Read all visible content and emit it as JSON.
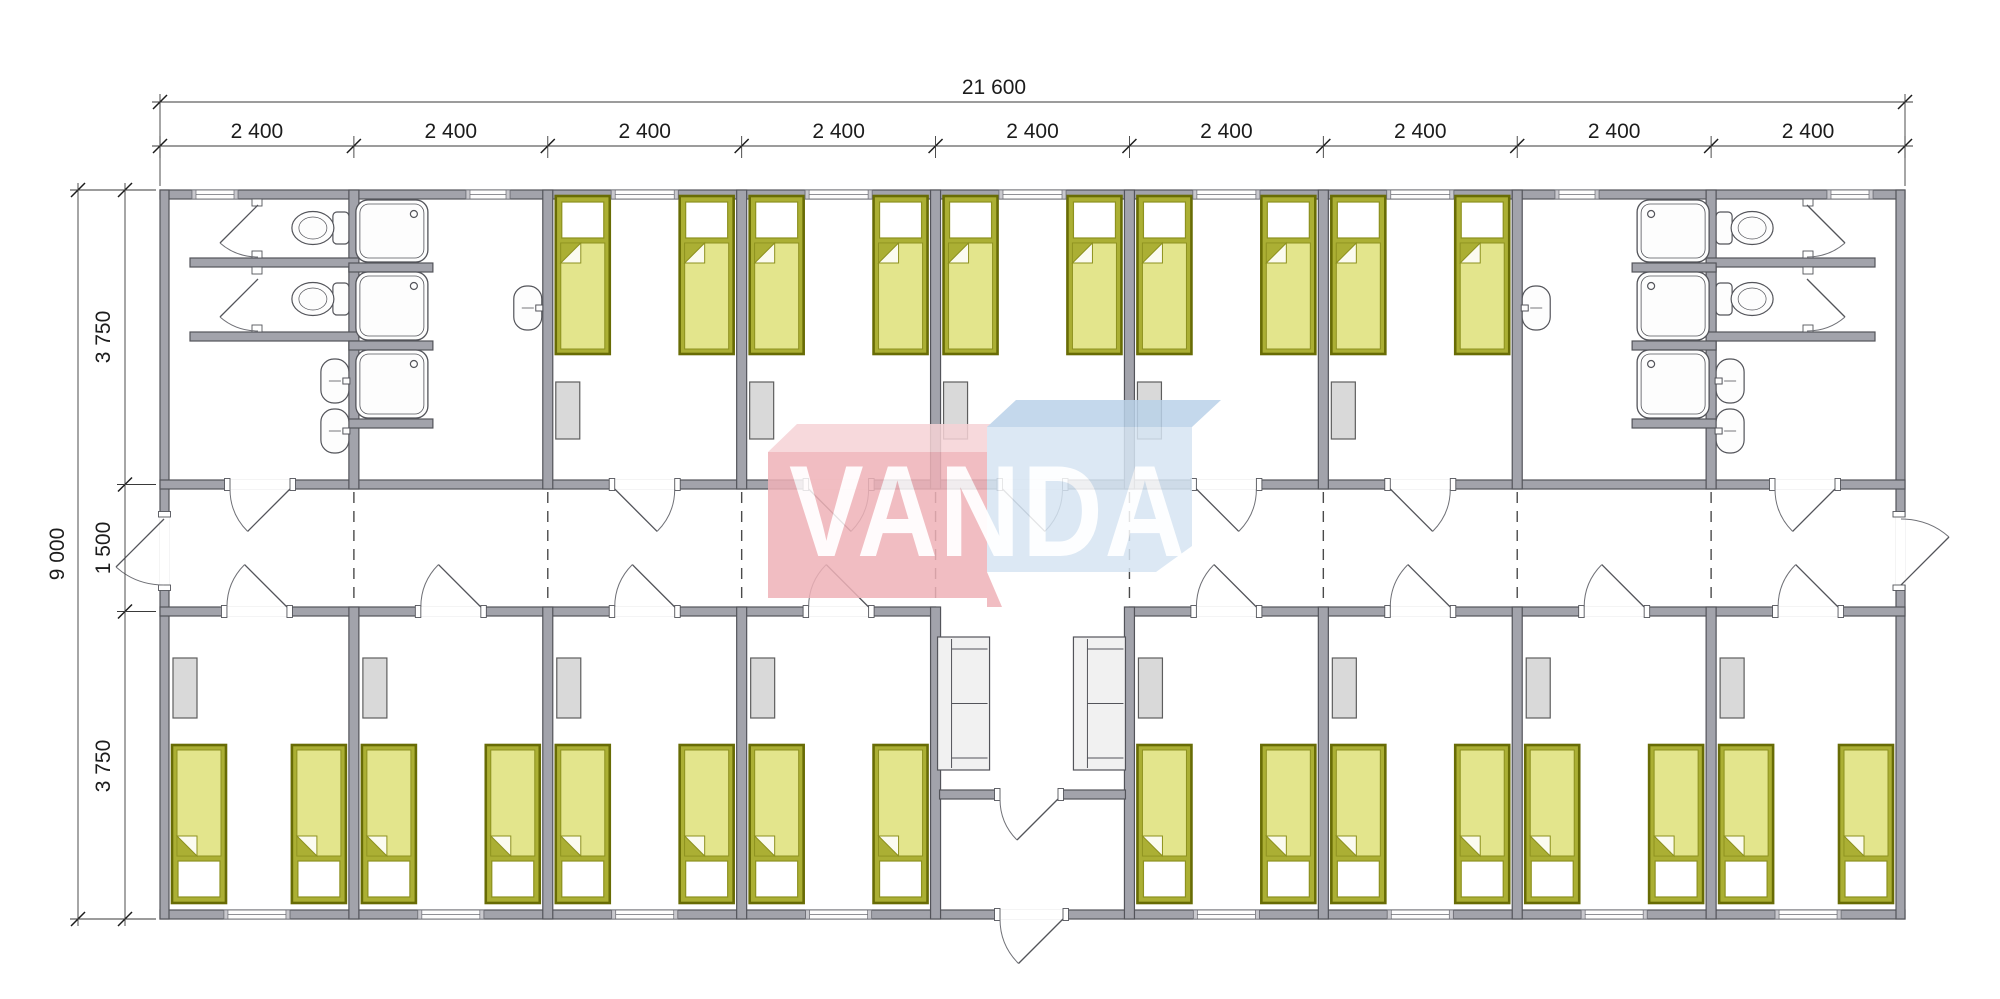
{
  "drawing": {
    "type": "architectural-floor-plan",
    "dimensions": {
      "overall_width_label": "21 600",
      "module_labels": [
        "2 400",
        "2 400",
        "2 400",
        "2 400",
        "2 400",
        "2 400",
        "2 400",
        "2 400",
        "2 400"
      ],
      "overall_height_label": "9 000",
      "height_segment_labels": [
        "3 750",
        "1 500",
        "3 750"
      ]
    },
    "watermark": {
      "text": "VANDA",
      "red_front": "#efb2b8",
      "red_top": "#f6d3d6",
      "blue_front": "#d6e5f3",
      "blue_top": "#bad2e9",
      "text_color": "#ffffff"
    },
    "palette": {
      "wall_fill": "#a2a3ab",
      "wall_stroke": "#53545a",
      "line": "#53545a",
      "arc": "#6f7076",
      "bed_border": "#686c05",
      "bed_frame": "#abaf34",
      "bed_blanket": "#e3e58c",
      "bed_inner_stroke": "#8d911f",
      "bed_pillow": "#ffffff",
      "wardrobe_fill": "#d9d9d9",
      "wardrobe_stroke": "#5e5e5e",
      "sofa_fill": "#f1f1f1",
      "fixture_fill": "#fdfdfd",
      "window_cap": "#c9c9ce",
      "dashed": "#4a4a4a",
      "dim_color": "#1c1c1c"
    },
    "building": {
      "module_count": 9,
      "rooms_top": [
        "sanitary-wc",
        "washroom-showers",
        "bedroom",
        "bedroom",
        "bedroom",
        "bedroom",
        "bedroom",
        "washroom-showers",
        "sanitary-wc"
      ],
      "rooms_bottom": [
        "bedroom",
        "bedroom",
        "bedroom",
        "bedroom",
        "entrance-lobby",
        "bedroom",
        "bedroom",
        "bedroom",
        "bedroom"
      ],
      "corridor_between_rows": true,
      "furniture_counts": {
        "single_beds": 26,
        "wardrobes": 13,
        "sofas": 2,
        "toilets": 4,
        "shower_trays": 6,
        "wash_basins": 6
      }
    }
  }
}
